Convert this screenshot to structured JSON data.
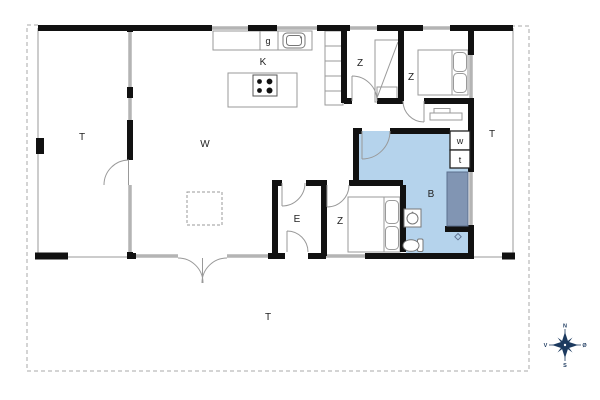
{
  "plan_title": "holiday-house-floor-plan",
  "rooms": {
    "terrace_west": "T",
    "living": "W",
    "kitchen": "K",
    "cabinet": "g",
    "bedroom1": "Z",
    "bedroom2": "Z",
    "bedroom3": "Z",
    "entry": "E",
    "bathroom": "B",
    "washer": "w",
    "dryer": "t",
    "terrace_east": "T",
    "terrace_south": "T"
  },
  "compass": {
    "north": "N",
    "east": "Ø",
    "south": "S",
    "west": "V"
  },
  "colors": {
    "wall": "#111111",
    "window": "#b4b4b4",
    "bath_floor": "#b5d3ec",
    "shower": "#8195b3",
    "shower_edge": "#5c6f8e",
    "bath_label": "#274a74",
    "compass": "#1c3a5f",
    "label": "#222222"
  },
  "fixtures": [
    "kitchen-sink",
    "cooktop",
    "kitchen-island",
    "wardrobe",
    "bunk-bed",
    "double-bed",
    "double-bed",
    "shelf",
    "washbasin",
    "toilet",
    "shower",
    "floor-drain"
  ]
}
